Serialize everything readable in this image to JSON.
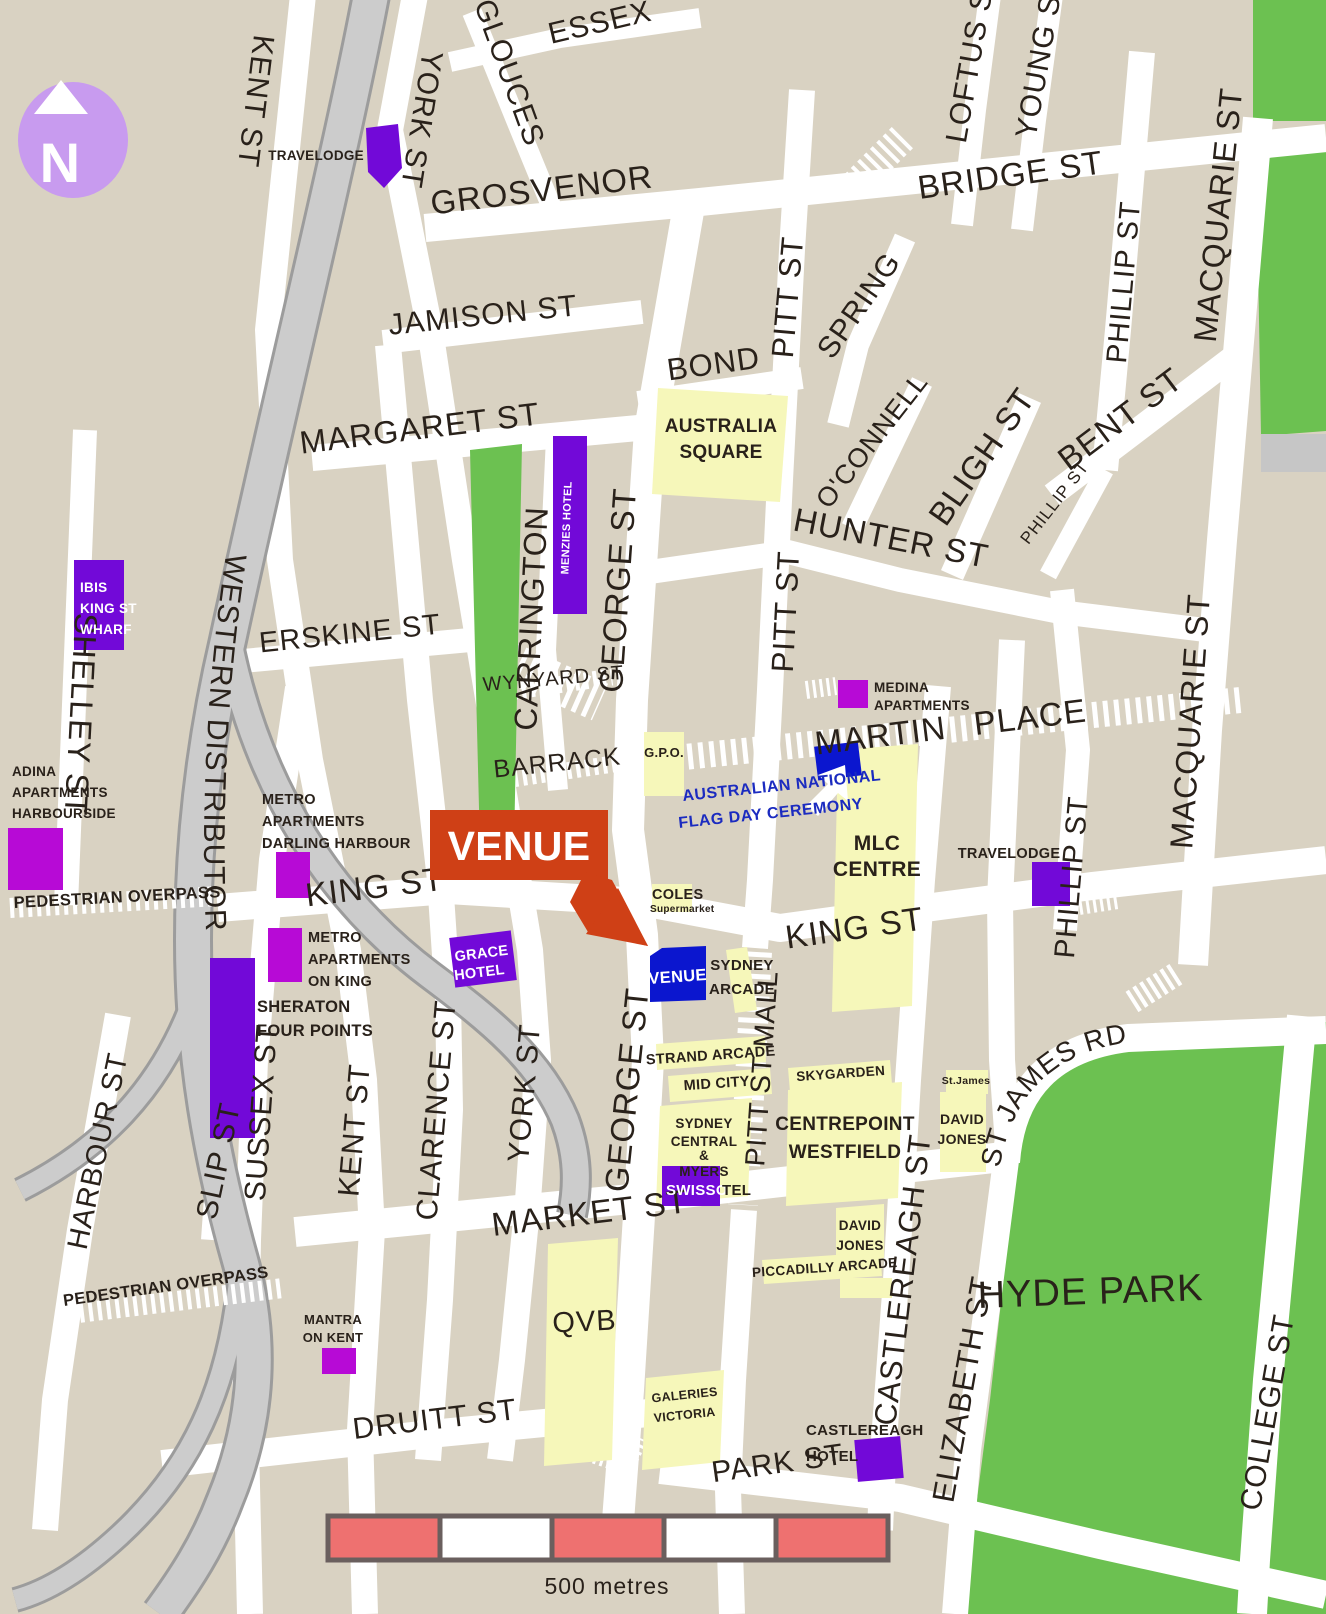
{
  "title": "Sydney CBD venue location map",
  "compass": {
    "letter": "N"
  },
  "scale": {
    "label": "500 metres"
  },
  "venue": {
    "callout": "VENUE",
    "marker": "VENUE"
  },
  "ceremony": {
    "line1": "AUSTRALIAN NATIONAL",
    "line2": "FLAG DAY CEREMONY"
  },
  "streets": {
    "kent_st_top": "KENT ST",
    "york_st_top": "YORK ST",
    "gloucester": "GLOUCES",
    "essex": "ESSEX",
    "shelley": "SHELLEY ST",
    "western_distributor": "WESTERN DISTRIBUTOR",
    "grosvenor": "GROSVENOR",
    "bridge": "BRIDGE ST",
    "loftus": "LOFTUS S",
    "young": "YOUNG S",
    "jamison": "JAMISON ST",
    "margaret": "MARGARET ST",
    "bond": "BOND",
    "pitt_upper": "PITT ST",
    "pitt_mid": "PITT ST",
    "spring": "SPRING",
    "oconnell": "O'CONNELL",
    "bligh": "BLIGH ST",
    "bent": "BENT ST",
    "phillip_upper": "PHILLIP ST",
    "phillip_small": "PHILLIP ST",
    "phillip_lower": "PHILLIP ST",
    "macquarie_top": "MACQUARIE ST",
    "macquarie_mid": "MACQUARIE ST",
    "hunter": "HUNTER ST",
    "erskine": "ERSKINE ST",
    "wynyard": "WYNYARD ST",
    "barrack": "BARRACK",
    "carrington": "CARRINGTON",
    "george_upper": "GEORGE ST",
    "george_lower": "GEORGE ST",
    "martin_place": "MARTIN PLACE",
    "king_west": "KING ST",
    "king_east": "KING ST",
    "market": "MARKET ST",
    "pitt_mall": "PITT ST MALL",
    "castlereagh": "CASTLEREAGH ST",
    "elizabeth": "ELIZABETH ST",
    "college": "COLLEGE ST",
    "st_james_rd": "ST JAMES RD",
    "sussex": "SUSSEX ST",
    "slip": "SLIP ST",
    "harbour": "HARBOUR ST",
    "kent_lower": "KENT ST",
    "clarence": "CLARENCE ST",
    "york_lower": "YORK ST",
    "druitt": "DRUITT ST",
    "park": "PARK ST",
    "pedestrian_overpass_1": "PEDESTRIAN OVERPASS",
    "pedestrian_overpass_2": "PEDESTRIAN OVERPASS"
  },
  "places": {
    "travelodge_top": "TRAVELODGE",
    "menzies": "MENZIES HOTEL",
    "ibis_1": "IBIS",
    "ibis_2": "KING ST",
    "ibis_3": "WHARF",
    "adina_1": "ADINA",
    "adina_2": "APARTMENTS",
    "adina_3": "HARBOURSIDE",
    "medina_1": "MEDINA",
    "medina_2": "APARTMENTS",
    "metro_dh_1": "METRO",
    "metro_dh_2": "APARTMENTS",
    "metro_dh_3": "DARLING HARBOUR",
    "metro_k_1": "METRO",
    "metro_k_2": "APARTMENTS",
    "metro_k_3": "ON KING",
    "sheraton_1": "SHERATON",
    "sheraton_2": "FOUR POINTS",
    "grace_1": "GRACE",
    "grace_2": "HOTEL",
    "travelodge_right": "TRAVELODGE",
    "mlc_1": "MLC",
    "mlc_2": "CENTRE",
    "gpo": "G.P.O.",
    "australia_square_1": "AUSTRALIA",
    "australia_square_2": "SQUARE",
    "coles_1": "COLES",
    "coles_2": "Supermarket",
    "sydney_arcade_1": "SYDNEY",
    "sydney_arcade_2": "ARCADE",
    "strand_arcade": "STRAND ARCADE",
    "mid_city": "MID CITY",
    "skygarden": "SKYGARDEN",
    "st_james_building": "St.James",
    "centrepoint_1": "CENTREPOINT",
    "centrepoint_2": "WESTFIELD",
    "david_jones_north_1": "DAVID",
    "david_jones_north_2": "JONES",
    "david_jones_south_1": "DAVID",
    "david_jones_south_2": "JONES",
    "piccadilly_arcade": "PICCADILLY ARCADE",
    "sydney_central_1": "SYDNEY",
    "sydney_central_2": "CENTRAL",
    "sydney_central_3": "&",
    "sydney_central_4": "MYERS",
    "swissotel_1": "SWISSO",
    "swissotel_2": "TEL",
    "qvb": "QVB",
    "galeries_1": "GALERIES",
    "galeries_2": "VICTORIA",
    "castlereagh_hotel_1": "CASTLEREAGH",
    "castlereagh_hotel_2": "HOTEL",
    "mantra_1": "MANTRA",
    "mantra_2": "ON KENT",
    "hyde_park": "HYDE PARK"
  },
  "colors": {
    "background": "#d9d2c2",
    "road": "#ffffff",
    "park_green": "#6cc151",
    "building_yellow": "#f6f7ba",
    "hotel_purple": "#7209d8",
    "apartment_magenta": "#b70ad6",
    "venue_blue": "#0b16cf",
    "callout_red": "#cf4016",
    "compass_lavender": "#c89bef",
    "freeway_gray": "#cccccc",
    "freeway_casing": "#9c9c9c",
    "scale_red": "#ee7170",
    "scale_border": "#6a5f5e",
    "label_dark": "#29211a",
    "ceremony_blue": "#1b2bc0"
  }
}
